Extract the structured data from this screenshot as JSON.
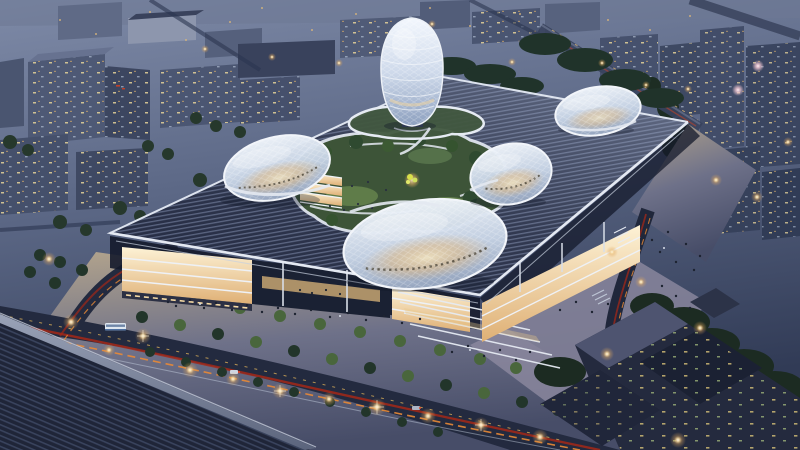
{
  "meta": {
    "description": "Aerial dusk rendering of a futuristic campus: a vast louvered podium roof carrying four white gridshell blob pavilions, an egg-shaped lattice tower and a sunken green courtyard; warm-lit glass facades and plazas below, streets with car light trails and street lamps, surrounded by a blue-grey evening city.",
    "type": "architectural-rendering",
    "time_of_day": "dusk"
  },
  "scene": {
    "objects": [
      "egg-shaped gridshell tower",
      "gridshell pavilion west",
      "gridshell pavilion center",
      "gridshell pavilion east",
      "gridshell pavilion northeast",
      "louvered podium roof",
      "sunken courtyard garden",
      "lit glass facades",
      "entrance plaza with people",
      "street lamps",
      "car light trails",
      "surrounding city towers",
      "foreground louvered roof",
      "dark courtyard office block",
      "city bus"
    ]
  },
  "palette": {
    "sky_top": "#7e8aa7",
    "sky_mid": "#5c6886",
    "sky_bottom": "#313b56",
    "roof_stripe_dark": "#272e45",
    "roof_stripe_light": "#5a6480",
    "roof_fascia": "#e4e9f2",
    "fg_stripe_dark": "#1f2538",
    "fg_stripe_light": "#39435d",
    "fg_fascia": "#8b94aa",
    "shell_top": "#eff4fa",
    "shell_mid": "#c6d3e5",
    "shell_bottom": "#96a6c0",
    "warm_glow": "#f8e7bd",
    "egg_top": "#f3f7fd",
    "egg_mid": "#cfdaeb",
    "egg_bottom": "#8da0bf",
    "floor_light": "#fdf2d6",
    "floor_deep": "#dfb075",
    "lawn": "#3d5438",
    "lawn_light": "#5f7c49",
    "tree_dark": "#22352a",
    "tree_lit": "#49663c",
    "plaza_light": "#b3a48c",
    "plaza_mid": "#6e7189",
    "plaza_dark": "#474d68",
    "road": "#232a3f",
    "trail_red": "#a32818",
    "trail_orange": "#e98a36",
    "trail_yellow": "#f2c05c",
    "streak_white": "#ccd6e6",
    "lamp_core": "#fff6e4",
    "lamp_glow": "#f7dca6",
    "lamp_pink": "#f4c9d4",
    "block_face": "#4e5975",
    "block_face_dark": "#3c4660",
    "block_top": "#677290",
    "block_pale": "#8d96ad",
    "dark_building": "#242a3e",
    "dark_building_roof": "#4e5470",
    "window_warm": "#e6d49a",
    "window_cool": "#b9c6da",
    "shadow": "#0e1424"
  }
}
